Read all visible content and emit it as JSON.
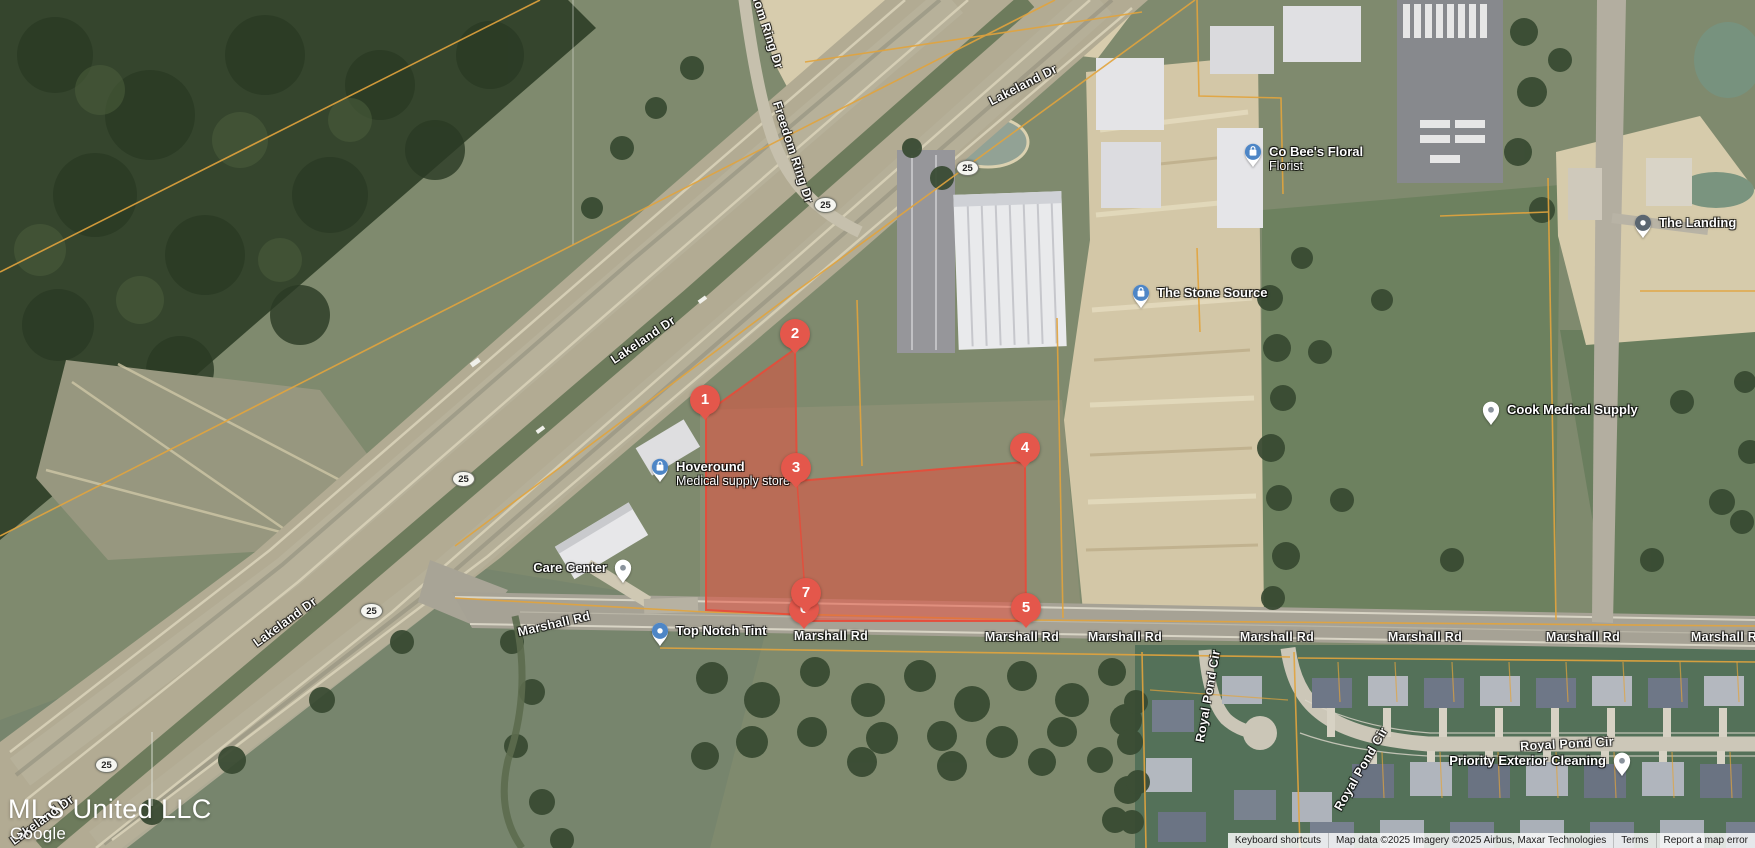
{
  "map": {
    "watermark": "MLS United LLC",
    "brand": "Google",
    "shield_text": "25",
    "shields": [
      {
        "x": 826,
        "y": 205
      },
      {
        "x": 968,
        "y": 168
      },
      {
        "x": 464,
        "y": 479
      },
      {
        "x": 372,
        "y": 611
      },
      {
        "x": 107,
        "y": 765
      }
    ],
    "road_labels": [
      {
        "text": "Lakeland Dr",
        "x": 1023,
        "y": 85,
        "rot": -27
      },
      {
        "text": "Lakeland Dr",
        "x": 643,
        "y": 340,
        "rot": -34
      },
      {
        "text": "Lakeland Dr",
        "x": 285,
        "y": 622,
        "rot": -36
      },
      {
        "text": "Lakeland Dr",
        "x": 42,
        "y": 820,
        "rot": -36
      },
      {
        "text": "Freedom Ring Dr",
        "x": 763,
        "y": 18,
        "rot": 72
      },
      {
        "text": "Freedom Ring Dr",
        "x": 793,
        "y": 152,
        "rot": 72
      },
      {
        "text": "Marshall Rd",
        "x": 554,
        "y": 624,
        "rot": -13
      },
      {
        "text": "Marshall Rd",
        "x": 831,
        "y": 636,
        "rot": 0
      },
      {
        "text": "Marshall Rd",
        "x": 1022,
        "y": 637,
        "rot": 0
      },
      {
        "text": "Marshall Rd",
        "x": 1125,
        "y": 637,
        "rot": 0
      },
      {
        "text": "Marshall Rd",
        "x": 1277,
        "y": 637,
        "rot": 0
      },
      {
        "text": "Marshall Rd",
        "x": 1425,
        "y": 637,
        "rot": 0
      },
      {
        "text": "Marshall Rd",
        "x": 1583,
        "y": 637,
        "rot": 0
      },
      {
        "text": "Marshall Rd",
        "x": 1728,
        "y": 637,
        "rot": 0
      },
      {
        "text": "Royal Pond Cir",
        "x": 1208,
        "y": 696,
        "rot": -80
      },
      {
        "text": "Royal Pond Cir",
        "x": 1361,
        "y": 769,
        "rot": -60
      },
      {
        "text": "Royal Pond Cir",
        "x": 1567,
        "y": 744,
        "rot": -3
      }
    ],
    "pois": [
      {
        "id": "hoveround",
        "name": "Hoveround",
        "sub": "Medical supply store",
        "icon": "shopping-bag",
        "x": 660,
        "y": 467,
        "side": "right"
      },
      {
        "id": "care-center",
        "name": "Care Center",
        "icon": "place",
        "x": 623,
        "y": 568,
        "side": "left"
      },
      {
        "id": "top-notch-tint",
        "name": "Top Notch Tint",
        "icon": "dot-blue",
        "x": 660,
        "y": 631,
        "side": "right"
      },
      {
        "id": "the-stone-source",
        "name": "The Stone Source",
        "icon": "shopping-bag",
        "x": 1141,
        "y": 293,
        "side": "right"
      },
      {
        "id": "co-bees-floral",
        "name": "Co Bee's Floral",
        "sub": "Florist",
        "icon": "shopping-bag",
        "x": 1253,
        "y": 152,
        "side": "right"
      },
      {
        "id": "cook-medical-supply",
        "name": "Cook Medical Supply",
        "icon": "place",
        "x": 1491,
        "y": 410,
        "side": "right"
      },
      {
        "id": "the-landing",
        "name": "The Landing",
        "icon": "place-dark",
        "x": 1643,
        "y": 223,
        "side": "right"
      },
      {
        "id": "priority-exterior-cleaning",
        "name": "Priority Exterior Cleaning",
        "icon": "place",
        "x": 1622,
        "y": 761,
        "side": "left"
      }
    ],
    "markers": [
      {
        "n": "1",
        "x": 705,
        "y": 400
      },
      {
        "n": "2",
        "x": 795,
        "y": 334
      },
      {
        "n": "3",
        "x": 796,
        "y": 468
      },
      {
        "n": "4",
        "x": 1025,
        "y": 448
      },
      {
        "n": "5",
        "x": 1026,
        "y": 608
      },
      {
        "n": "6",
        "x": 804,
        "y": 609
      },
      {
        "n": "7",
        "x": 806,
        "y": 593
      }
    ],
    "attribution": {
      "keyboard_shortcuts": "Keyboard shortcuts",
      "map_data": "Map data ©2025  Imagery ©2025 Airbus, Maxar Technologies",
      "terms": "Terms",
      "report_error": "Report a map error"
    }
  }
}
